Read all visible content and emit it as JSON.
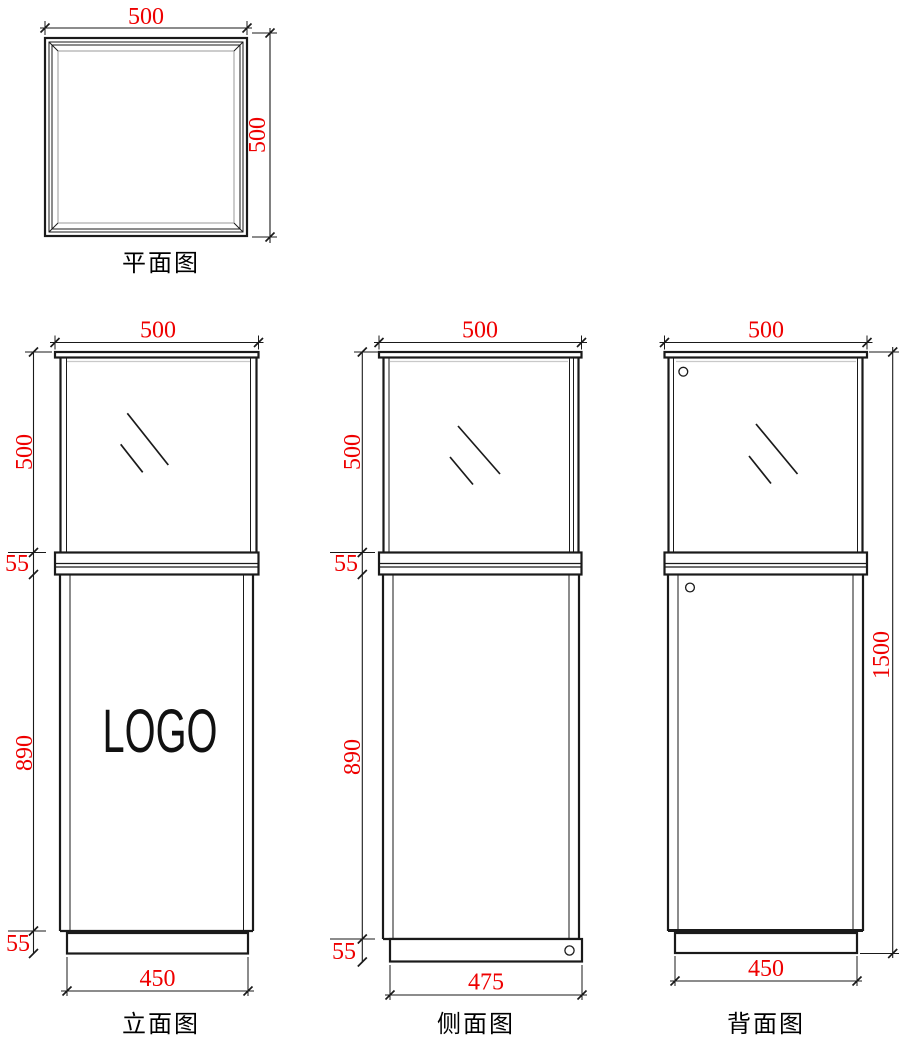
{
  "colors": {
    "line": "#1a1a1a",
    "dim": "#ee0000",
    "light": "#c9c9c9"
  },
  "plan": {
    "label": "平面图",
    "width": "500",
    "depth": "500"
  },
  "front": {
    "label": "立面图",
    "top_width": "500",
    "glass_height": "500",
    "counter_height": "55",
    "body_height": "890",
    "base_height": "55",
    "base_width": "450",
    "logo": "LOGO"
  },
  "side": {
    "label": "侧面图",
    "top_width": "500",
    "glass_height": "500",
    "counter_height": "55",
    "body_height": "890",
    "base_height": "55",
    "base_width": "475"
  },
  "back": {
    "label": "背面图",
    "top_width": "500",
    "total_height": "1500",
    "base_width": "450"
  }
}
